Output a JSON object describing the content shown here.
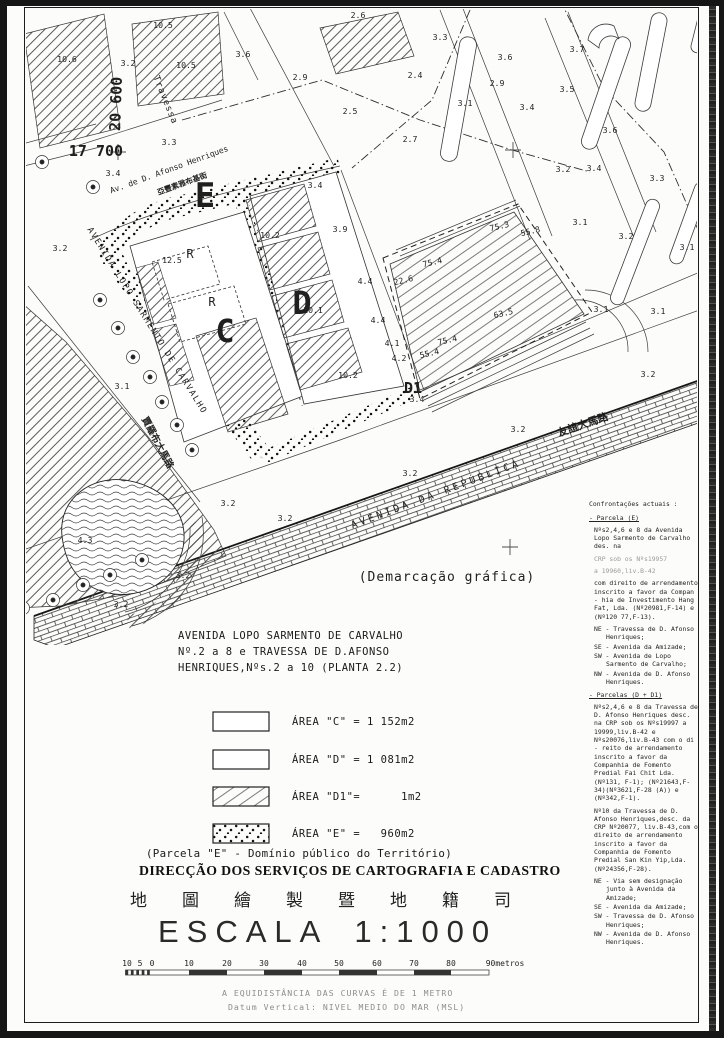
{
  "map": {
    "street_labels": [
      {
        "t": "Travessa",
        "x": 163,
        "y": 101,
        "r": 68,
        "fs": 9,
        "ls": 1,
        "n": "street-label-travessa"
      },
      {
        "t": "20 600",
        "x": 121,
        "y": 104,
        "r": -88,
        "fs": 15,
        "b": true,
        "ff": "Liberation Sans",
        "n": "grid-coordinate-20600"
      },
      {
        "t": "17 700",
        "x": 96,
        "y": 156,
        "fs": 15,
        "b": true,
        "ff": "Liberation Sans",
        "n": "grid-coordinate-17700"
      },
      {
        "t": "Av. de D. Afonso Henriques",
        "x": 170,
        "y": 172,
        "r": -20,
        "fs": 8,
        "n": "street-label-afonso-henriques"
      },
      {
        "t": "亞豐素雅布基街",
        "x": 183,
        "y": 186,
        "r": -20,
        "fs": 7.5,
        "b": true,
        "ff": "sans-serif",
        "n": "street-label-afonso-henriques-chinese"
      },
      {
        "t": "AVENIDA LOPO SARMENTO DE CARVALHO",
        "x": 145,
        "y": 322,
        "r": 58,
        "fs": 8.5,
        "ls": 1.5,
        "n": "street-label-lopo-sarmento"
      },
      {
        "t": "賈羅布大馬路",
        "x": 155,
        "y": 444,
        "r": 62,
        "fs": 9.5,
        "b": true,
        "ff": "sans-serif",
        "n": "street-label-lopo-sarmento-chinese"
      },
      {
        "t": "AVENIDA  DA  REPÚBLICA",
        "x": 437,
        "y": 497,
        "r": -20.5,
        "fs": 10,
        "ls": 3,
        "n": "street-label-republica"
      },
      {
        "t": "友誼大馬路",
        "x": 584,
        "y": 428,
        "r": -19,
        "fs": 10.5,
        "b": true,
        "ff": "sans-serif",
        "n": "street-label-amizade-chinese"
      },
      {
        "t": "(Demarcação gráfica)",
        "x": 447,
        "y": 581,
        "fs": 13,
        "ls": 1,
        "n": "note-demarcacao-grafica"
      }
    ],
    "area_letters": [
      {
        "t": "E",
        "x": 205,
        "y": 207,
        "fs": 34,
        "b": true
      },
      {
        "t": "C",
        "x": 225,
        "y": 342,
        "fs": 32,
        "b": true
      },
      {
        "t": "D",
        "x": 302,
        "y": 314,
        "fs": 32,
        "b": true
      },
      {
        "t": "D1",
        "x": 413,
        "y": 393,
        "fs": 15,
        "b": true
      },
      {
        "t": "R",
        "x": 190,
        "y": 258,
        "fs": 12
      },
      {
        "t": "R",
        "x": 212,
        "y": 306,
        "fs": 12
      }
    ],
    "point_labels": [
      {
        "t": "10.6",
        "x": 67,
        "y": 62
      },
      {
        "t": "10.5",
        "x": 163,
        "y": 28
      },
      {
        "t": "10.5",
        "x": 186,
        "y": 68
      },
      {
        "t": "3.2",
        "x": 128,
        "y": 66
      },
      {
        "t": "3.6",
        "x": 243,
        "y": 57
      },
      {
        "t": "2.6",
        "x": 358,
        "y": 18
      },
      {
        "t": "3.3",
        "x": 169,
        "y": 145
      },
      {
        "t": "3.4",
        "x": 113,
        "y": 176
      },
      {
        "t": "3.2",
        "x": 60,
        "y": 251
      },
      {
        "t": "3.1",
        "x": 122,
        "y": 389
      },
      {
        "t": "2.9",
        "x": 300,
        "y": 80
      },
      {
        "t": "2.4",
        "x": 415,
        "y": 78
      },
      {
        "t": "2.5",
        "x": 350,
        "y": 114
      },
      {
        "t": "2.7",
        "x": 410,
        "y": 142
      },
      {
        "t": "3.3",
        "x": 440,
        "y": 40
      },
      {
        "t": "3.1",
        "x": 465,
        "y": 106
      },
      {
        "t": "3.6",
        "x": 505,
        "y": 60
      },
      {
        "t": "2.9",
        "x": 497,
        "y": 86
      },
      {
        "t": "3.4",
        "x": 527,
        "y": 110
      },
      {
        "t": "3.5",
        "x": 567,
        "y": 92
      },
      {
        "t": "3.7",
        "x": 577,
        "y": 52
      },
      {
        "t": "3.6",
        "x": 610,
        "y": 133
      },
      {
        "t": "3.2",
        "x": 563,
        "y": 172
      },
      {
        "t": "3.4",
        "x": 594,
        "y": 171
      },
      {
        "t": "3.3",
        "x": 657,
        "y": 181
      },
      {
        "t": "3.2",
        "x": 626,
        "y": 239
      },
      {
        "t": "3.1",
        "x": 687,
        "y": 250
      },
      {
        "t": "3.1",
        "x": 601,
        "y": 312
      },
      {
        "t": "3.1",
        "x": 658,
        "y": 314
      },
      {
        "t": "3.2",
        "x": 648,
        "y": 377
      },
      {
        "t": "3.1",
        "x": 580,
        "y": 225
      },
      {
        "t": "3.4",
        "x": 315,
        "y": 188
      },
      {
        "t": "3.9",
        "x": 340,
        "y": 232
      },
      {
        "t": "4.4",
        "x": 365,
        "y": 284
      },
      {
        "t": "4.4",
        "x": 378,
        "y": 323
      },
      {
        "t": "4.1",
        "x": 392,
        "y": 346
      },
      {
        "t": "4.2",
        "x": 399,
        "y": 361
      },
      {
        "t": "12.5",
        "x": 172,
        "y": 263
      },
      {
        "t": "10.2",
        "x": 270,
        "y": 238
      },
      {
        "t": "10.1",
        "x": 313,
        "y": 313
      },
      {
        "t": "10.2",
        "x": 348,
        "y": 378
      },
      {
        "t": "3.4",
        "x": 417,
        "y": 402
      },
      {
        "t": "3.2",
        "x": 410,
        "y": 476
      },
      {
        "t": "3.2",
        "x": 518,
        "y": 432
      },
      {
        "t": "3.2",
        "x": 285,
        "y": 521
      },
      {
        "t": "3.2",
        "x": 228,
        "y": 506
      },
      {
        "t": "3.2",
        "x": 183,
        "y": 578
      },
      {
        "t": "3.2",
        "x": 121,
        "y": 607
      },
      {
        "t": "4.3",
        "x": 85,
        "y": 543
      },
      {
        "t": "75.3",
        "x": 500,
        "y": 229,
        "r": -13
      },
      {
        "t": "55.8",
        "x": 531,
        "y": 234,
        "r": -13
      },
      {
        "t": "75.4",
        "x": 433,
        "y": 265,
        "r": -13
      },
      {
        "t": "22.6",
        "x": 404,
        "y": 283,
        "r": -13
      },
      {
        "t": "63.5",
        "x": 504,
        "y": 316,
        "r": -13
      },
      {
        "t": "75.4",
        "x": 448,
        "y": 343,
        "r": -13
      },
      {
        "t": "55.4",
        "x": 430,
        "y": 356,
        "r": -13
      }
    ]
  },
  "sidebar": {
    "title": "Confrontações actuais :",
    "sections": [
      {
        "heading": "- Parcela (E)",
        "p1": "Nºs2,4,6 e 8 da Avenida Lopo Sarmento de Carvalho des. na",
        "p2": "CRP sob os Nºs19957",
        "p3": "a 19960,liv.B-42",
        "p4": "com direito de arrendamento inscrito a favor da Compan - hia de Investimento Hang Fat, Lda. (Nº20981,F-14) e (Nº120 77,F-13).",
        "bounds": [
          "NE - Travessa de D. Afonso Henriques;",
          "SE - Avenida da Amizade;",
          "SW - Avenida de Lopo Sarmento de Carvalho;",
          "NW - Avenida de D. Afonso Henriques."
        ]
      },
      {
        "heading": "- Parcelas (D + D1)",
        "p1": "Nºs2,4,6 e 8 da Travessa de D. Afonso Henriques desc. na CRP sob os Nºs19997 a 19999,liv.B-42 e Nºs20076,liv.B-43 com o di - reito de arrendamento inscrito a favor da Companhia de Fomento Predial Fai Chit Lda. (Nº131, F-1); (Nº21643,F-34)(Nº3621,F-28 (A)) e (Nº342,F-1).",
        "p2": "Nº10 da Travessa de D. Afonso Henriques,desc. da CRP Nº20077, liv.B-43,com o direito de arrendamento inscrito a favor da Companhia de Fomento Predial San Kin Yip,Lda. (Nº24356,F-28).",
        "bounds": [
          "NE - Via sem designação junto à Avenida da Amizade;",
          "SE - Avenida da Amizade;",
          "SW - Travessa de D. Afonso Henriques;",
          "NW - Avenida de D. Afonso Henriques."
        ]
      }
    ]
  },
  "title_block": {
    "line1": "AVENIDA LOPO SARMENTO DE CARVALHO",
    "line2": "Nº.2 a 8 e TRAVESSA DE D.AFONSO",
    "line3": "HENRIQUES,Nºs.2 a 10 (PLANTA 2.2)"
  },
  "legend": {
    "items": [
      {
        "label": "ÁREA \"C\" = 1 152m2",
        "pattern": "plain"
      },
      {
        "label": "ÁREA \"D\" = 1 081m2",
        "pattern": "plain"
      },
      {
        "label": "ÁREA \"D1\"=      1m2",
        "pattern": "hatch"
      },
      {
        "label": "ÁREA \"E\" =   960m2",
        "pattern": "stipple"
      }
    ],
    "note": "(Parcela \"E\" - Domínio público do Território)"
  },
  "footer": {
    "direccao": "DIRECÇÃO DOS SERVIÇOS DE CARTOGRAFIA E CADASTRO",
    "chinese_title": "地圖繪製暨地籍司",
    "escala_label": "ESCALA",
    "escala_value": "1:1000",
    "equidistancia": "A EQUIDISTÂNCIA DAS CURVAS É DE 1 METRO",
    "datum": "Datum Vertical: NIVEL MEDIO DO MAR (MSL)"
  },
  "scale_bar": {
    "labels": [
      {
        "t": "10",
        "x": 127
      },
      {
        "t": "5",
        "x": 140
      },
      {
        "t": "0",
        "x": 152
      },
      {
        "t": "10",
        "x": 189
      },
      {
        "t": "20",
        "x": 227
      },
      {
        "t": "30",
        "x": 264
      },
      {
        "t": "40",
        "x": 302
      },
      {
        "t": "50",
        "x": 339
      },
      {
        "t": "60",
        "x": 377
      },
      {
        "t": "70",
        "x": 414
      },
      {
        "t": "80",
        "x": 451
      },
      {
        "t": "90metros",
        "x": 505
      }
    ]
  }
}
